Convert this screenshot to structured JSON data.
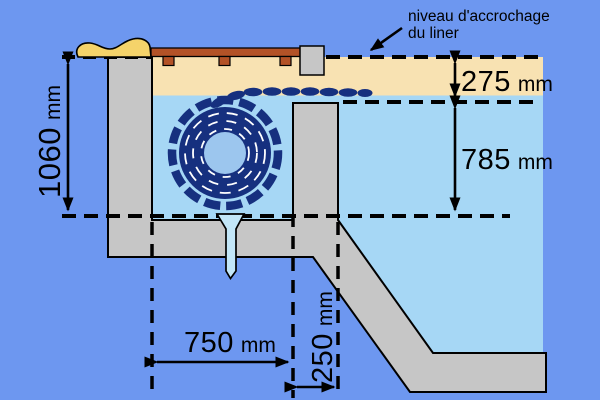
{
  "annotation": {
    "line1": "niveau d'accrochage",
    "line2": "du liner"
  },
  "dimensions": {
    "overall_height": {
      "value": "1060",
      "unit": "mm"
    },
    "liner_to_water": {
      "value": "275",
      "unit": "mm"
    },
    "water_to_floor": {
      "value": "785",
      "unit": "mm"
    },
    "pit_width": {
      "value": "750",
      "unit": "mm"
    },
    "wall_offset": {
      "value": "250",
      "unit": "mm"
    }
  },
  "colors": {
    "background": "#6d97f0",
    "water": "#a6d7f5",
    "deck": "#f8e2b2",
    "concrete": "#c6c6c6",
    "cover_navy": "#16307f",
    "axle": "#9cc6ee",
    "beam_brown": "#b35227",
    "flap_yellow": "#f5d36a",
    "drain": "#c2e6f8",
    "line": "#000000"
  }
}
